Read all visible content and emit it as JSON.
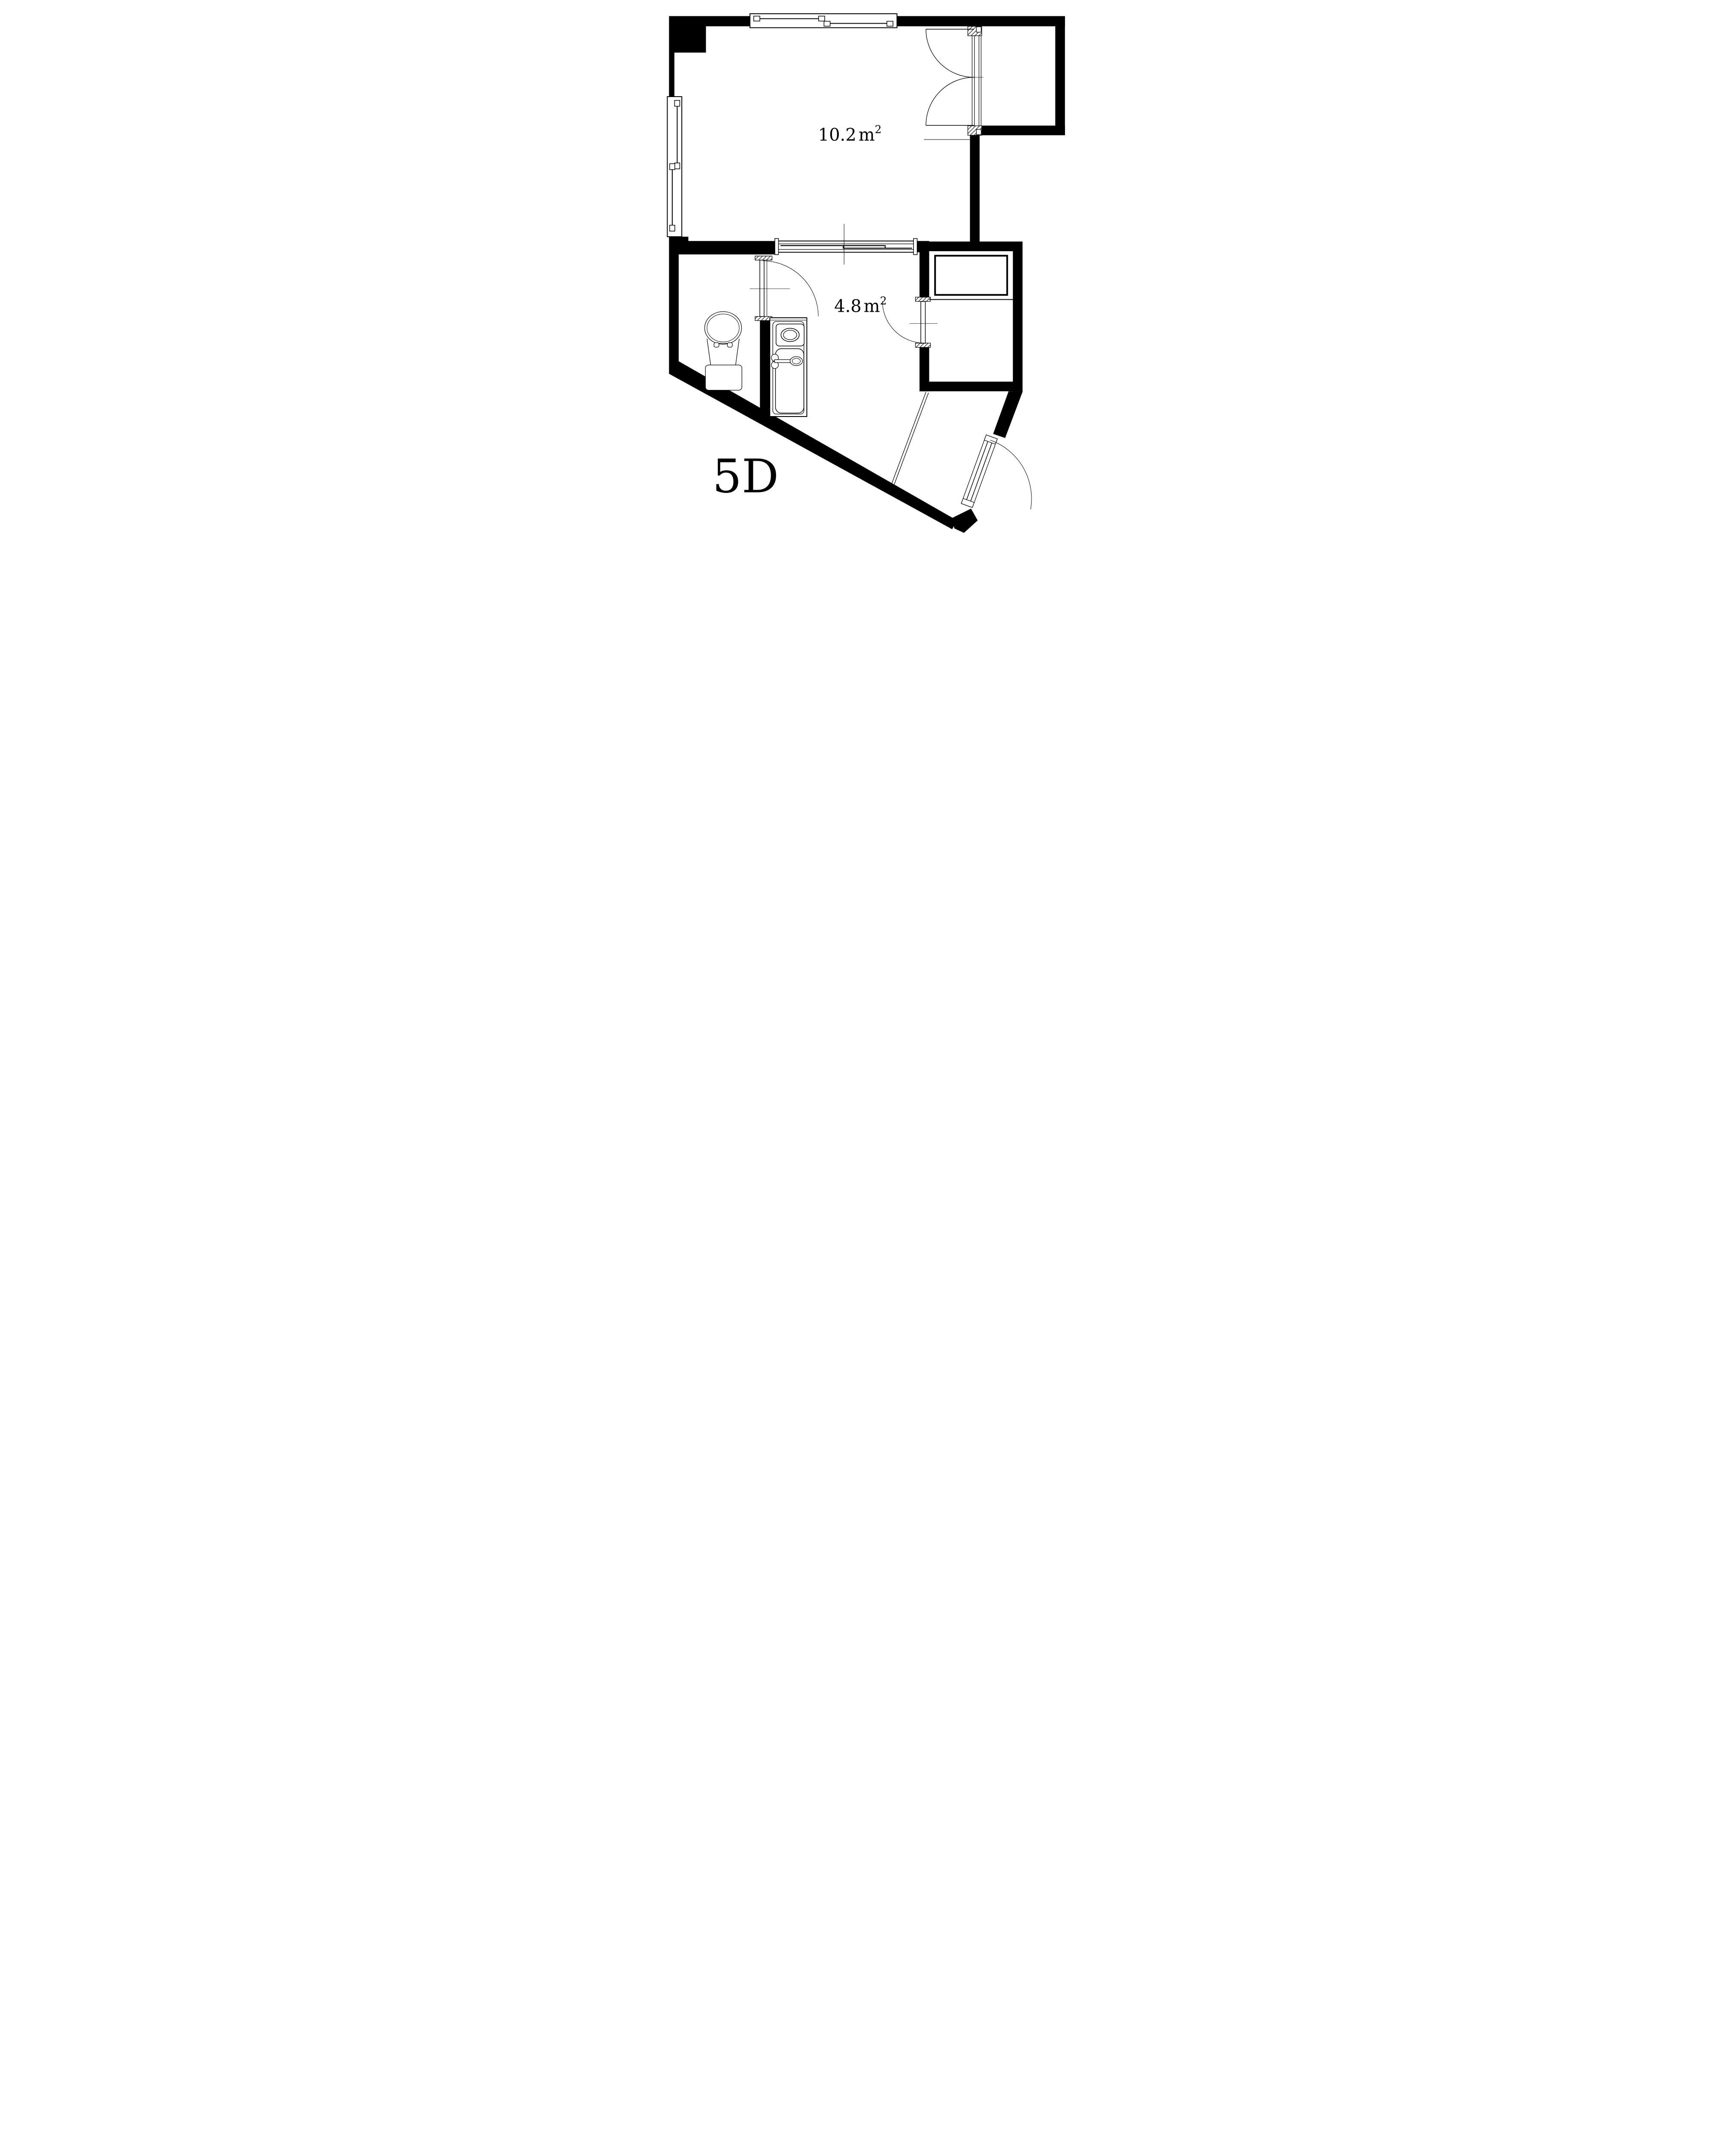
{
  "unit_label": "5D",
  "rooms": [
    {
      "name": "main room",
      "area_value": "10.2",
      "area_unit": "m",
      "area_exponent": "2"
    },
    {
      "name": "kitchen room",
      "area_value": "4.8",
      "area_unit": "m",
      "area_exponent": "2"
    }
  ],
  "colors": {
    "wall": "#000000",
    "lines": "#000000",
    "background": "#ffffff"
  },
  "fixtures": [
    "toilet",
    "kitchen-counter-with-stove-and-sink",
    "storage-closet"
  ],
  "openings": [
    "top-sliding-window",
    "left-sliding-window",
    "interior-sliding-partition",
    "double-swing-door",
    "bathroom-swing-door",
    "closet-swing-door",
    "entry-swing-door"
  ]
}
